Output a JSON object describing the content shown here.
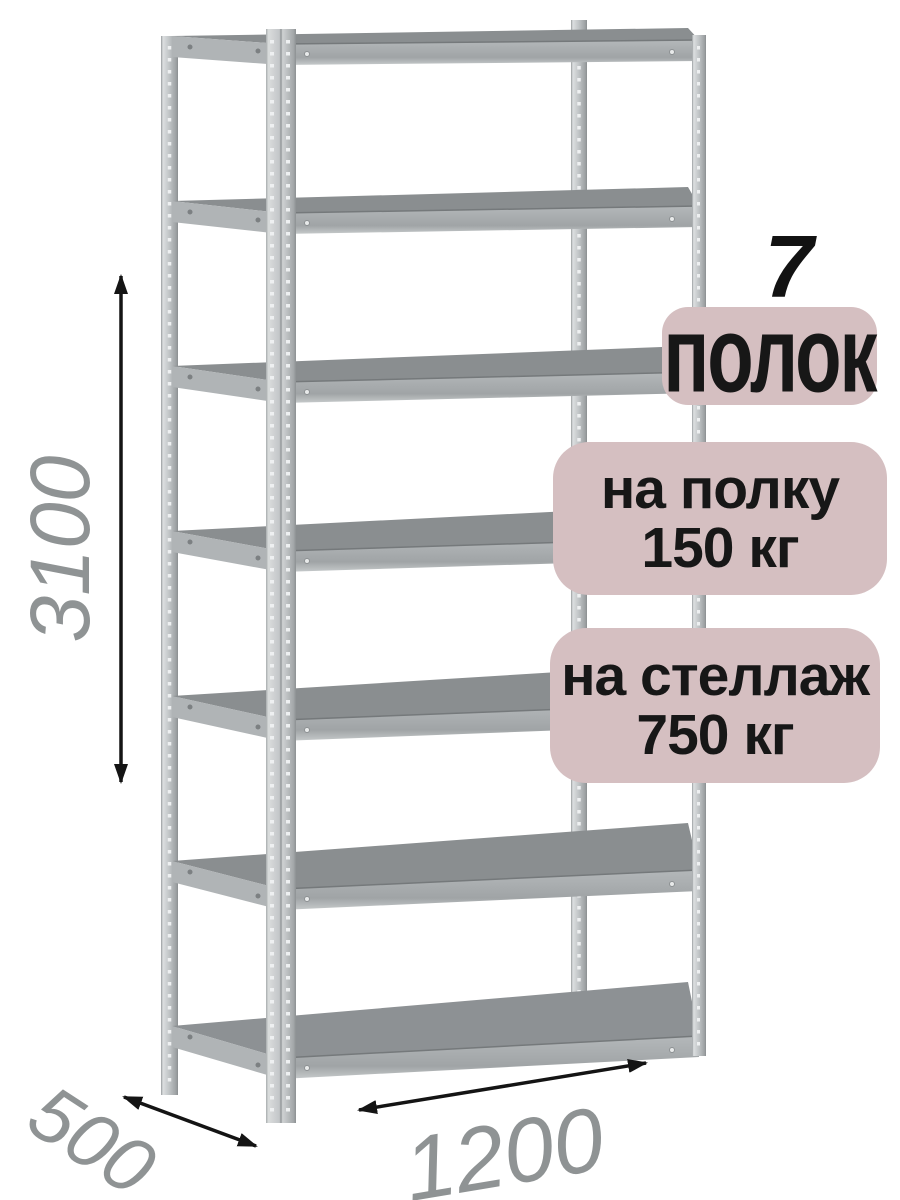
{
  "product": {
    "shelf_count_value": "7",
    "shelf_count_label": "полок",
    "per_shelf_load": {
      "line1": "на полку",
      "line2": "150 кг"
    },
    "per_rack_load": {
      "line1": "на стеллаж",
      "line2": "750 кг"
    }
  },
  "dimensions": {
    "height_mm": "3100",
    "depth_mm": "500",
    "width_mm": "1200"
  },
  "illustration": {
    "type": "metal-shelving-rack",
    "shelves_drawn": 7,
    "posts_drawn": 4
  },
  "colors": {
    "background": "#ffffff",
    "badge_bg": "#d5bfc1",
    "badge_text": "#171717",
    "dimension_text": "#8f9394",
    "arrow": "#141414",
    "shelf_top_surface": "#8a8e90",
    "shelf_front_band": "#a9adaf",
    "post_metal_light": "#dcdfe0",
    "post_metal_dark": "#8a8e90"
  }
}
